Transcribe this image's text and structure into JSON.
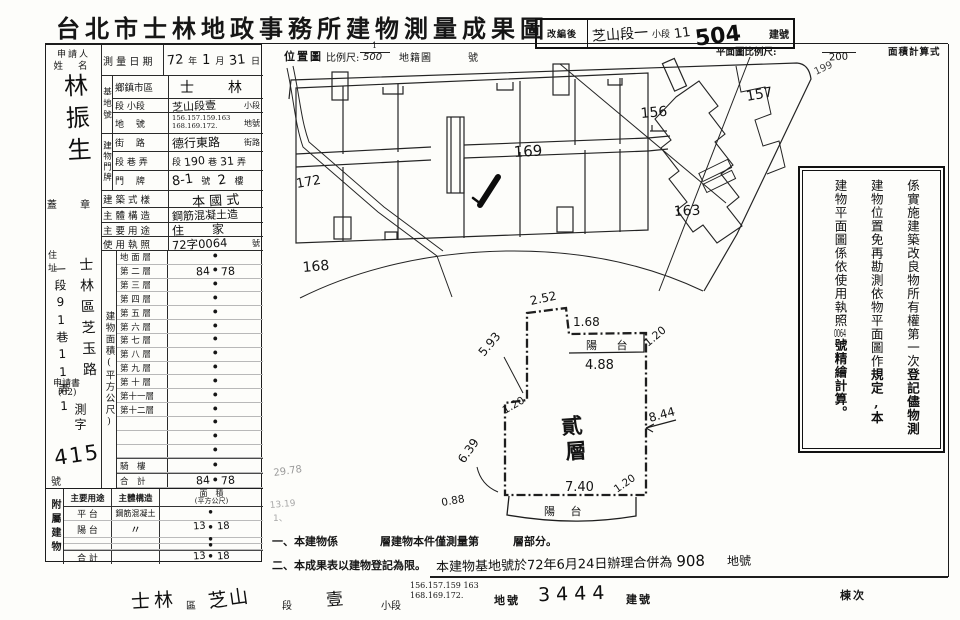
{
  "colors": {
    "ink": "#161616",
    "paper": "#fdfdfa",
    "faint_pencil": "#9a9a9a"
  },
  "title": "台北市士林地政事務所建物測量成果圖",
  "renumber": {
    "label": "改編後",
    "hand1": "芝山段一",
    "print1": "小段",
    "hand2": "11",
    "hand3": "504",
    "print2": "建號"
  },
  "scales": {
    "loc": "位置圖",
    "ratio_label": "比例尺:",
    "num": "1",
    "den": "500",
    "cad": "地籍圖",
    "no": "號",
    "plan_label": "平面圖比例尺:",
    "plan_den": "200",
    "calc": "面積計算式"
  },
  "applicant": {
    "head": "申請人",
    "name_label": "姓 名",
    "name": "林振生",
    "seal": "蓋 章",
    "addr_label": "住 址",
    "addr1": "士林區芝玉路",
    "addr2": "一段91巷11弄1",
    "doc": "申請書",
    "doc_year": "(62)",
    "doc_word": "測字",
    "doc_no": "415",
    "doc_suffix": "號"
  },
  "survey": {
    "g1": "基地號",
    "g2": "建物門牌",
    "r1": {
      "label": "測 量 日 期",
      "h1": "72",
      "p1": "年",
      "h2": "1",
      "p2": "月",
      "h3": "31",
      "p3": "日"
    },
    "r2": {
      "label": "鄉鎮市區",
      "value": "士　林"
    },
    "r3": {
      "label": "段 小段",
      "value": "芝山段壹",
      "suffix": "小段"
    },
    "r4": {
      "label": "地　 號",
      "line1": "156.157.159.163",
      "line2": "168.169.172.",
      "suffix": "地號"
    },
    "r5": {
      "label": "街　 路",
      "value": "德行東路",
      "suffix": "街路"
    },
    "r6": {
      "label": "段 巷 弄",
      "p1": "段",
      "h1": "190",
      "p2": "巷",
      "h2": "31",
      "p3": "弄"
    },
    "r7": {
      "label": "門　 牌",
      "h1": "8-1",
      "p1": "號",
      "h2": "2",
      "p2": "樓"
    },
    "r8": {
      "label": "建 築 式 樣",
      "value": "本 國 式"
    },
    "r9": {
      "label": "主 體 構 造",
      "value": "鋼筋混凝土造"
    },
    "r10": {
      "label": "主 要 用 途",
      "value": "住　家"
    },
    "r11": {
      "label": "使 用 執 照",
      "value": "72字0064",
      "suffix": "號"
    }
  },
  "area_table": {
    "vlabel": "建物面積(平方公尺)",
    "dot": "•",
    "rows": [
      {
        "label": "地 面 層",
        "value": ""
      },
      {
        "label": "第 二 層",
        "value": "84.78"
      },
      {
        "label": "第 三 層",
        "value": ""
      },
      {
        "label": "第 四 層",
        "value": ""
      },
      {
        "label": "第 五 層",
        "value": ""
      },
      {
        "label": "第 六 層",
        "value": ""
      },
      {
        "label": "第 七 層",
        "value": ""
      },
      {
        "label": "第 八 層",
        "value": ""
      },
      {
        "label": "第 九 層",
        "value": ""
      },
      {
        "label": "第 十 層",
        "value": ""
      },
      {
        "label": "第十一層",
        "value": ""
      },
      {
        "label": "第十二層",
        "value": ""
      },
      {
        "label": "",
        "value": ""
      },
      {
        "label": "",
        "value": ""
      },
      {
        "label": "",
        "value": ""
      },
      {
        "label": "騎　樓",
        "value": ""
      },
      {
        "label": "合　計",
        "value": "84.78"
      }
    ]
  },
  "attached": {
    "vlabel": "附屬建物",
    "h_use": "主要用途",
    "h_struct": "主體構造",
    "h_area1": "面　積",
    "h_area2": "(平方公尺)",
    "rows": [
      {
        "use": "平 台",
        "struct": "鋼筋混凝土",
        "value": ""
      },
      {
        "use": "陽 台",
        "struct": "〃",
        "value": "13.18"
      },
      {
        "use": "",
        "struct": "",
        "value": ""
      },
      {
        "use": "",
        "struct": "",
        "value": ""
      },
      {
        "use": "合 計",
        "struct": "",
        "value": "13.18"
      }
    ]
  },
  "notes": {
    "n1a": "一、本建物係",
    "n1b": "層建物本件僅測量第",
    "n1c": "層部分。",
    "n2": "二、本成果表以建物登記為限。",
    "merge": "本建物基地號於72年6月24日辦理合併為",
    "merge_no": "908",
    "merge_suffix": "地號"
  },
  "strip": {
    "d1": "士林",
    "p1": "區",
    "d2": "芝山",
    "p2": "段",
    "d3": "壹",
    "p3": "小段",
    "nums1": "156.157.159 163",
    "nums2": "168.169.172.",
    "p4": "地號",
    "d4": "3444",
    "p5": "建號",
    "p6": "棟次"
  },
  "stamp": {
    "c1a": "係實施建築改良物所有權第一次",
    "c1b": "登記儘物測",
    "c2a": "建物位置免再勘測依物平面圖作",
    "c2b": "規定,本",
    "c3a": "建物平面圖係依使用執照",
    "c3h": "0064",
    "c3b": "號精繪計算。"
  },
  "map": {
    "p172": "172",
    "p168": "168",
    "p169": "169",
    "p156": "156",
    "p157": "157",
    "p163": "163",
    "p199": "199"
  },
  "plan": {
    "floor1": "貳",
    "floor2": "層",
    "balcony_top": "陽 台",
    "balcony_bottom": "陽 台",
    "d252": "2.52",
    "d168": "1.68",
    "d488": "4.88",
    "d120a": "1.20",
    "d593": "5.93",
    "d120b": "1.20",
    "d639": "6.39",
    "d844": "8.44",
    "d740": "7.40",
    "d120c": "1.20",
    "d088": "0.88"
  },
  "pencil": {
    "a": "29.78",
    "b": "13.19",
    "c": "1、"
  }
}
